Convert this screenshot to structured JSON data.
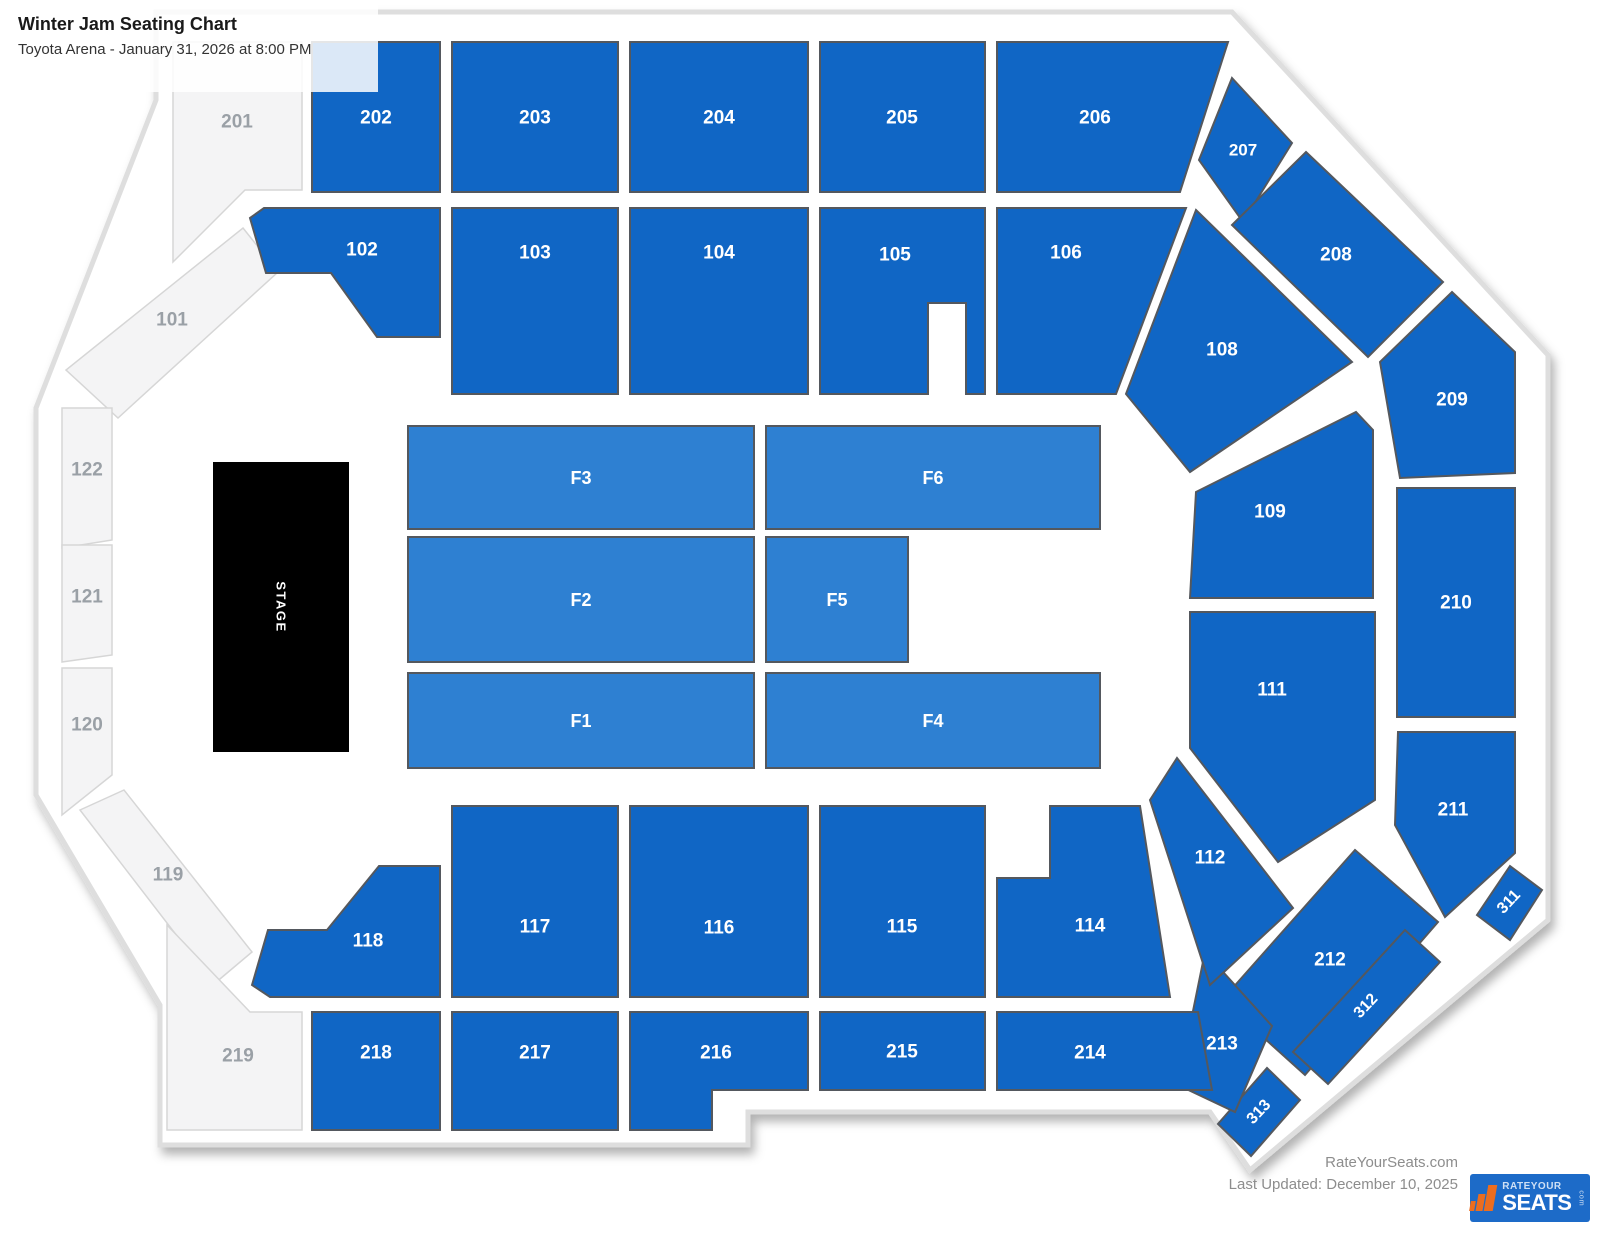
{
  "header": {
    "title": "Winter Jam Seating Chart",
    "subtitle": "Toyota Arena - January 31, 2026 at 8:00 PM"
  },
  "footer": {
    "site": "RateYourSeats.com",
    "last_updated": "Last Updated: December 10, 2025",
    "logo": {
      "top": "RATEYOUR",
      "main": "SEATS",
      "suffix": "com"
    }
  },
  "map": {
    "colors": {
      "standard": "#1066c5",
      "floor": "#2e80d2",
      "unavailable": "#f4f4f5",
      "stage": "#000000",
      "section_border": "#54585e",
      "unavailable_border": "#d6d6d6",
      "label": "#ffffff",
      "unavailable_label": "#9aa0a6",
      "outline": "#dedede"
    },
    "outline_path": "M 156,12 L 1232,12 L 1548,355 L 1548,920 L 1250,1170 L 1210,1112 L 748,1112 L 748,1145 L 160,1145 L 160,1005 L 36,795 L 36,408 L 156,100 Z",
    "font_sizes": {
      "standard": 19,
      "floor": 18,
      "unavailable": 19,
      "stage": 13
    },
    "sections": [
      {
        "id": "201",
        "label": "201",
        "type": "unavailable",
        "points": "173,42 302,42 302,190 245,190 173,262",
        "lx": 237,
        "ly": 122
      },
      {
        "id": "101",
        "label": "101",
        "type": "unavailable",
        "points": "243,228 278,272 118,418 66,370",
        "lx": 172,
        "ly": 320
      },
      {
        "id": "122",
        "label": "122",
        "type": "unavailable",
        "points": "62,408 112,408 112,540 62,548",
        "lx": 87,
        "ly": 470
      },
      {
        "id": "121",
        "label": "121",
        "type": "unavailable",
        "points": "62,545 112,545 112,655 62,662",
        "lx": 87,
        "ly": 597
      },
      {
        "id": "120",
        "label": "120",
        "type": "unavailable",
        "points": "62,668 112,668 112,775 62,815",
        "lx": 87,
        "ly": 725
      },
      {
        "id": "119",
        "label": "119",
        "type": "unavailable",
        "points": "80,810 124,790 252,952 214,984",
        "lx": 168,
        "ly": 875
      },
      {
        "id": "219",
        "label": "219",
        "type": "unavailable",
        "points": "167,925 250,1012 302,1012 302,1130 167,1130",
        "lx": 238,
        "ly": 1056
      },
      {
        "id": "202",
        "label": "202",
        "type": "standard",
        "points": "312,42 440,42 440,192 312,192",
        "lx": 376,
        "ly": 118
      },
      {
        "id": "203",
        "label": "203",
        "type": "standard",
        "points": "452,42 618,42 618,192 452,192",
        "lx": 535,
        "ly": 118
      },
      {
        "id": "204",
        "label": "204",
        "type": "standard",
        "points": "630,42 808,42 808,192 630,192",
        "lx": 719,
        "ly": 118
      },
      {
        "id": "205",
        "label": "205",
        "type": "standard",
        "points": "820,42 985,42 985,192 820,192",
        "lx": 902,
        "ly": 118
      },
      {
        "id": "206",
        "label": "206",
        "type": "standard",
        "points": "997,42 1228,42 1180,192 997,192",
        "lx": 1095,
        "ly": 118
      },
      {
        "id": "207",
        "label": "207",
        "type": "standard",
        "points": "1232,78 1292,143 1243,222 1199,160",
        "lx": 1243,
        "ly": 150,
        "fs": 17
      },
      {
        "id": "208",
        "label": "208",
        "type": "standard",
        "points": "1306,152 1443,282 1368,357 1232,225",
        "lx": 1336,
        "ly": 255
      },
      {
        "id": "209",
        "label": "209",
        "type": "standard",
        "points": "1452,292 1515,352 1515,473 1400,478 1380,362",
        "lx": 1452,
        "ly": 400
      },
      {
        "id": "210",
        "label": "210",
        "type": "standard",
        "points": "1397,488 1515,488 1515,717 1397,717",
        "lx": 1456,
        "ly": 603
      },
      {
        "id": "211",
        "label": "211",
        "type": "standard",
        "points": "1398,732 1515,732 1515,853 1445,917 1395,825",
        "lx": 1453,
        "ly": 810
      },
      {
        "id": "311",
        "label": "311",
        "type": "standard",
        "points": "1510,866 1542,890 1510,940 1477,915",
        "lx": 1509,
        "ly": 902,
        "rot": -47,
        "fs": 16
      },
      {
        "id": "212",
        "label": "212",
        "type": "standard",
        "points": "1355,850 1438,922 1305,1075 1222,1000",
        "lx": 1330,
        "ly": 960
      },
      {
        "id": "312",
        "label": "312",
        "type": "standard",
        "points": "1440,962 1328,1084 1293,1052 1405,930",
        "lx": 1366,
        "ly": 1006,
        "rot": -47,
        "fs": 16
      },
      {
        "id": "313",
        "label": "313",
        "type": "standard",
        "points": "1300,1100 1251,1156 1218,1124 1267,1068",
        "lx": 1259,
        "ly": 1112,
        "rot": -47,
        "fs": 16
      },
      {
        "id": "213",
        "label": "213",
        "type": "standard",
        "points": "1205,952 1272,1026 1235,1112 1178,1085",
        "lx": 1222,
        "ly": 1044
      },
      {
        "id": "214",
        "label": "214",
        "type": "standard",
        "points": "997,1012 1198,1012 1212,1090 997,1090",
        "lx": 1090,
        "ly": 1053
      },
      {
        "id": "215",
        "label": "215",
        "type": "standard",
        "points": "820,1012 985,1012 985,1090 820,1090",
        "lx": 902,
        "ly": 1052
      },
      {
        "id": "216",
        "label": "216",
        "type": "standard",
        "points": "630,1012 808,1012 808,1090 712,1090 712,1130 630,1130",
        "lx": 716,
        "ly": 1053
      },
      {
        "id": "217",
        "label": "217",
        "type": "standard",
        "points": "452,1012 618,1012 618,1130 452,1130",
        "lx": 535,
        "ly": 1053
      },
      {
        "id": "218",
        "label": "218",
        "type": "standard",
        "points": "312,1012 440,1012 440,1130 312,1130",
        "lx": 376,
        "ly": 1053
      },
      {
        "id": "102",
        "label": "102",
        "type": "standard",
        "points": "250,218 264,208 440,208 440,337 377,337 331,273 266,273",
        "lx": 362,
        "ly": 250
      },
      {
        "id": "103",
        "label": "103",
        "type": "standard",
        "points": "452,208 618,208 618,394 452,394",
        "lx": 535,
        "ly": 253
      },
      {
        "id": "104",
        "label": "104",
        "type": "standard",
        "points": "630,208 808,208 808,394 630,394",
        "lx": 719,
        "ly": 253
      },
      {
        "id": "105",
        "label": "105",
        "type": "standard",
        "points": "820,208 985,208 985,394 966,394 966,303 928,303 928,394 820,394",
        "lx": 895,
        "ly": 255
      },
      {
        "id": "106",
        "label": "106",
        "type": "standard",
        "points": "997,208 1186,208 1116,394 997,394",
        "lx": 1066,
        "ly": 253
      },
      {
        "id": "108",
        "label": "108",
        "type": "standard",
        "points": "1196,210 1352,362 1190,472 1126,394",
        "lx": 1222,
        "ly": 350
      },
      {
        "id": "109",
        "label": "109",
        "type": "standard",
        "points": "1196,492 1356,412 1373,430 1373,598 1190,598",
        "lx": 1270,
        "ly": 512
      },
      {
        "id": "111",
        "label": "111",
        "type": "standard",
        "points": "1190,612 1375,612 1375,800 1278,862 1190,748",
        "lx": 1272,
        "ly": 690
      },
      {
        "id": "112",
        "label": "112",
        "type": "standard",
        "points": "1177,758 1293,908 1210,985 1150,800",
        "lx": 1210,
        "ly": 858
      },
      {
        "id": "114",
        "label": "114",
        "type": "standard",
        "points": "997,878 1050,878 1050,806 1140,806 1170,997 997,997",
        "lx": 1090,
        "ly": 926
      },
      {
        "id": "115",
        "label": "115",
        "type": "standard",
        "points": "820,806 985,806 985,997 820,997",
        "lx": 902,
        "ly": 927
      },
      {
        "id": "116",
        "label": "116",
        "type": "standard",
        "points": "630,806 808,806 808,997 630,997",
        "lx": 719,
        "ly": 928
      },
      {
        "id": "117",
        "label": "117",
        "type": "standard",
        "points": "452,806 618,806 618,997 452,997",
        "lx": 535,
        "ly": 927
      },
      {
        "id": "118",
        "label": "118",
        "type": "standard",
        "points": "252,985 268,930 327,930 379,866 440,866 440,997 270,997",
        "lx": 368,
        "ly": 941
      },
      {
        "id": "F3",
        "label": "F3",
        "type": "floor",
        "points": "408,426 754,426 754,529 408,529",
        "lx": 581,
        "ly": 478
      },
      {
        "id": "F2",
        "label": "F2",
        "type": "floor",
        "points": "408,537 754,537 754,662 408,662",
        "lx": 581,
        "ly": 600
      },
      {
        "id": "F1",
        "label": "F1",
        "type": "floor",
        "points": "408,673 754,673 754,768 408,768",
        "lx": 581,
        "ly": 721
      },
      {
        "id": "F6",
        "label": "F6",
        "type": "floor",
        "points": "766,426 1100,426 1100,529 766,529",
        "lx": 933,
        "ly": 478
      },
      {
        "id": "F5",
        "label": "F5",
        "type": "floor",
        "points": "766,537 908,537 908,662 766,662",
        "lx": 837,
        "ly": 600
      },
      {
        "id": "F4",
        "label": "F4",
        "type": "floor",
        "points": "766,673 1100,673 1100,768 766,768",
        "lx": 933,
        "ly": 721
      },
      {
        "id": "STAGE",
        "label": "STAGE",
        "type": "stage",
        "points": "213,462 349,462 349,752 213,752",
        "lx": 281,
        "ly": 607,
        "rot": 90,
        "fs": 13
      }
    ]
  }
}
